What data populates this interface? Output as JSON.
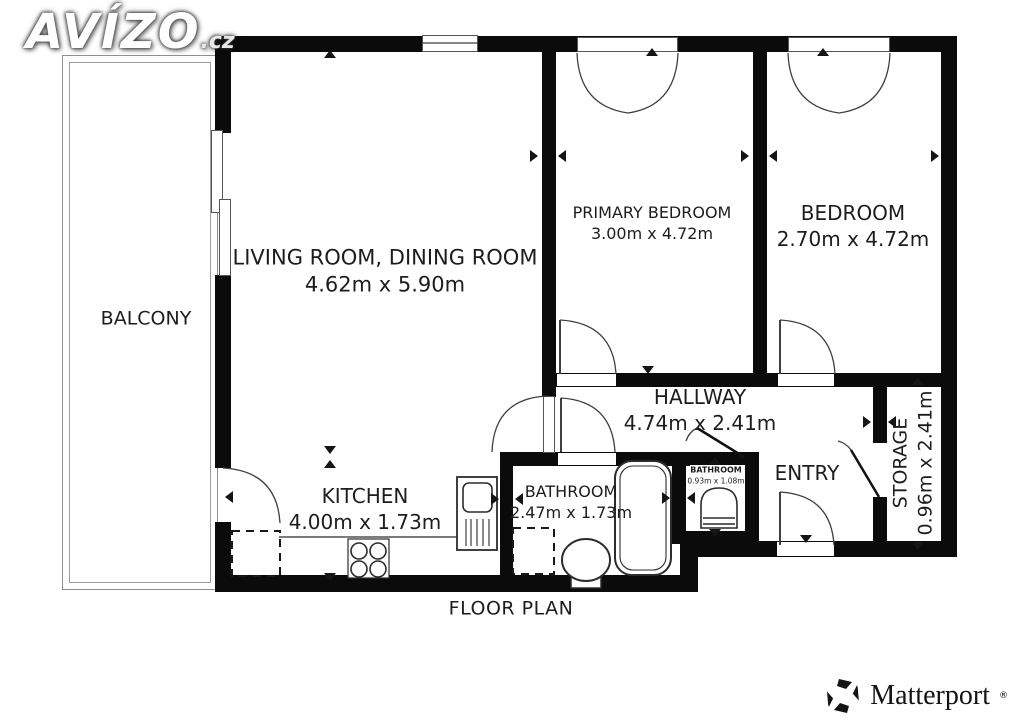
{
  "title": "FLOOR PLAN",
  "branding": {
    "logo_text": "AVÍZO",
    "logo_suffix": ".cz",
    "matterport_label": "Matterport",
    "matterport_reg": "®"
  },
  "rooms": {
    "balcony": {
      "name": "BALCONY"
    },
    "living": {
      "name": "LIVING ROOM, DINING ROOM",
      "dims": "4.62m x 5.90m"
    },
    "primary_bedroom": {
      "name": "PRIMARY BEDROOM",
      "dims": "3.00m x 4.72m"
    },
    "bedroom": {
      "name": "BEDROOM",
      "dims": "2.70m x 4.72m"
    },
    "hallway": {
      "name": "HALLWAY",
      "dims": "4.74m x 2.41m"
    },
    "kitchen": {
      "name": "KITCHEN",
      "dims": "4.00m x 1.73m"
    },
    "bathroom": {
      "name": "BATHROOM",
      "dims": "2.47m x 1.73m"
    },
    "bathroom_small": {
      "name": "BATHROOM",
      "dims": "0.93m x 1.08m"
    },
    "entry": {
      "name": "ENTRY"
    },
    "storage": {
      "name": "STORAGE",
      "dims": "0.96m x 2.41m"
    }
  },
  "fixtures": [
    "bathtub",
    "toilet",
    "toilet-small",
    "stove",
    "sink",
    "fridge-dashed",
    "washer-dashed"
  ],
  "colors": {
    "wall": "#0b0b0b",
    "line": "#3f3f3f",
    "text": "#1d1d1d",
    "background": "#ffffff"
  }
}
